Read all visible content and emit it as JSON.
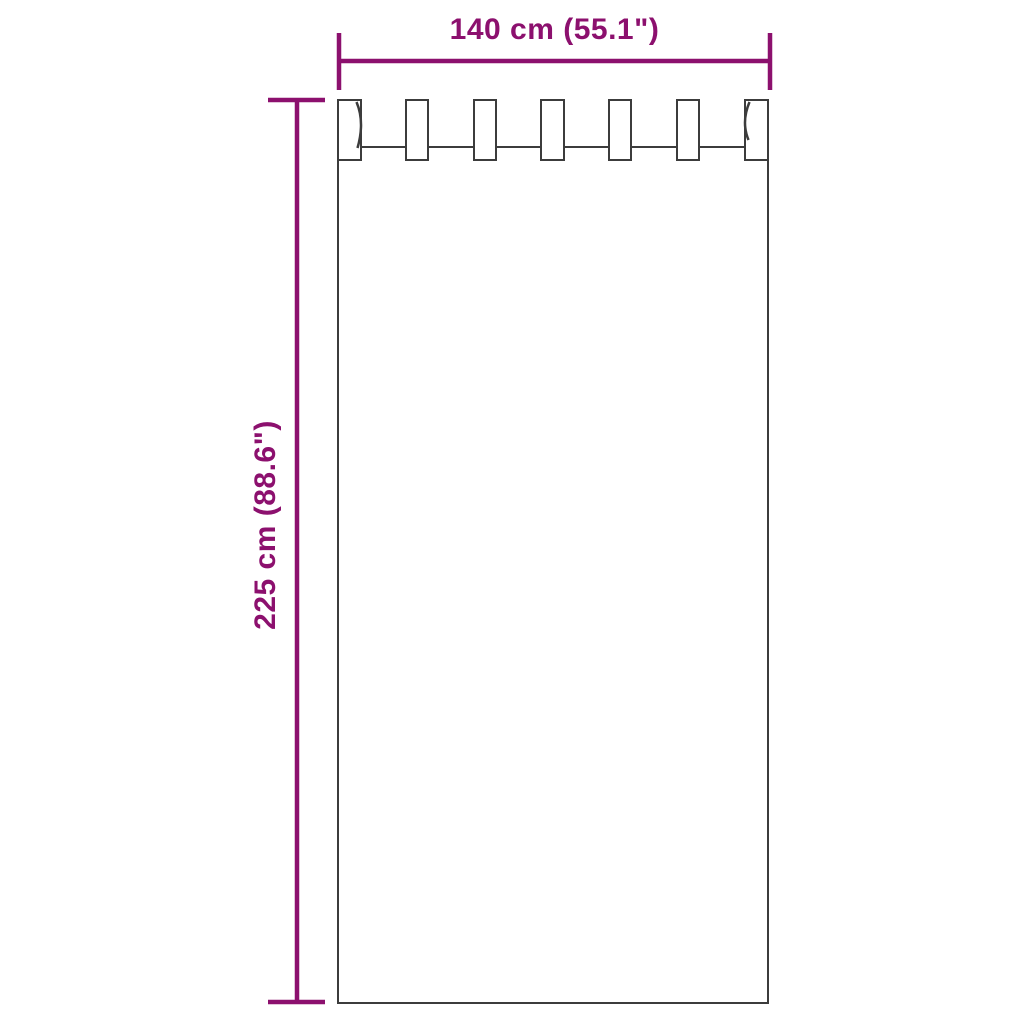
{
  "diagram": {
    "type": "product-dimension-diagram",
    "subject": "tab-top-curtain-panel",
    "width_label": "140 cm (55.1\")",
    "height_label": "225 cm (88.6\")",
    "tab_count": 7
  },
  "colors": {
    "dimension": "#8C106E",
    "outline": "#3C3C3C",
    "background": "#FFFFFF"
  }
}
